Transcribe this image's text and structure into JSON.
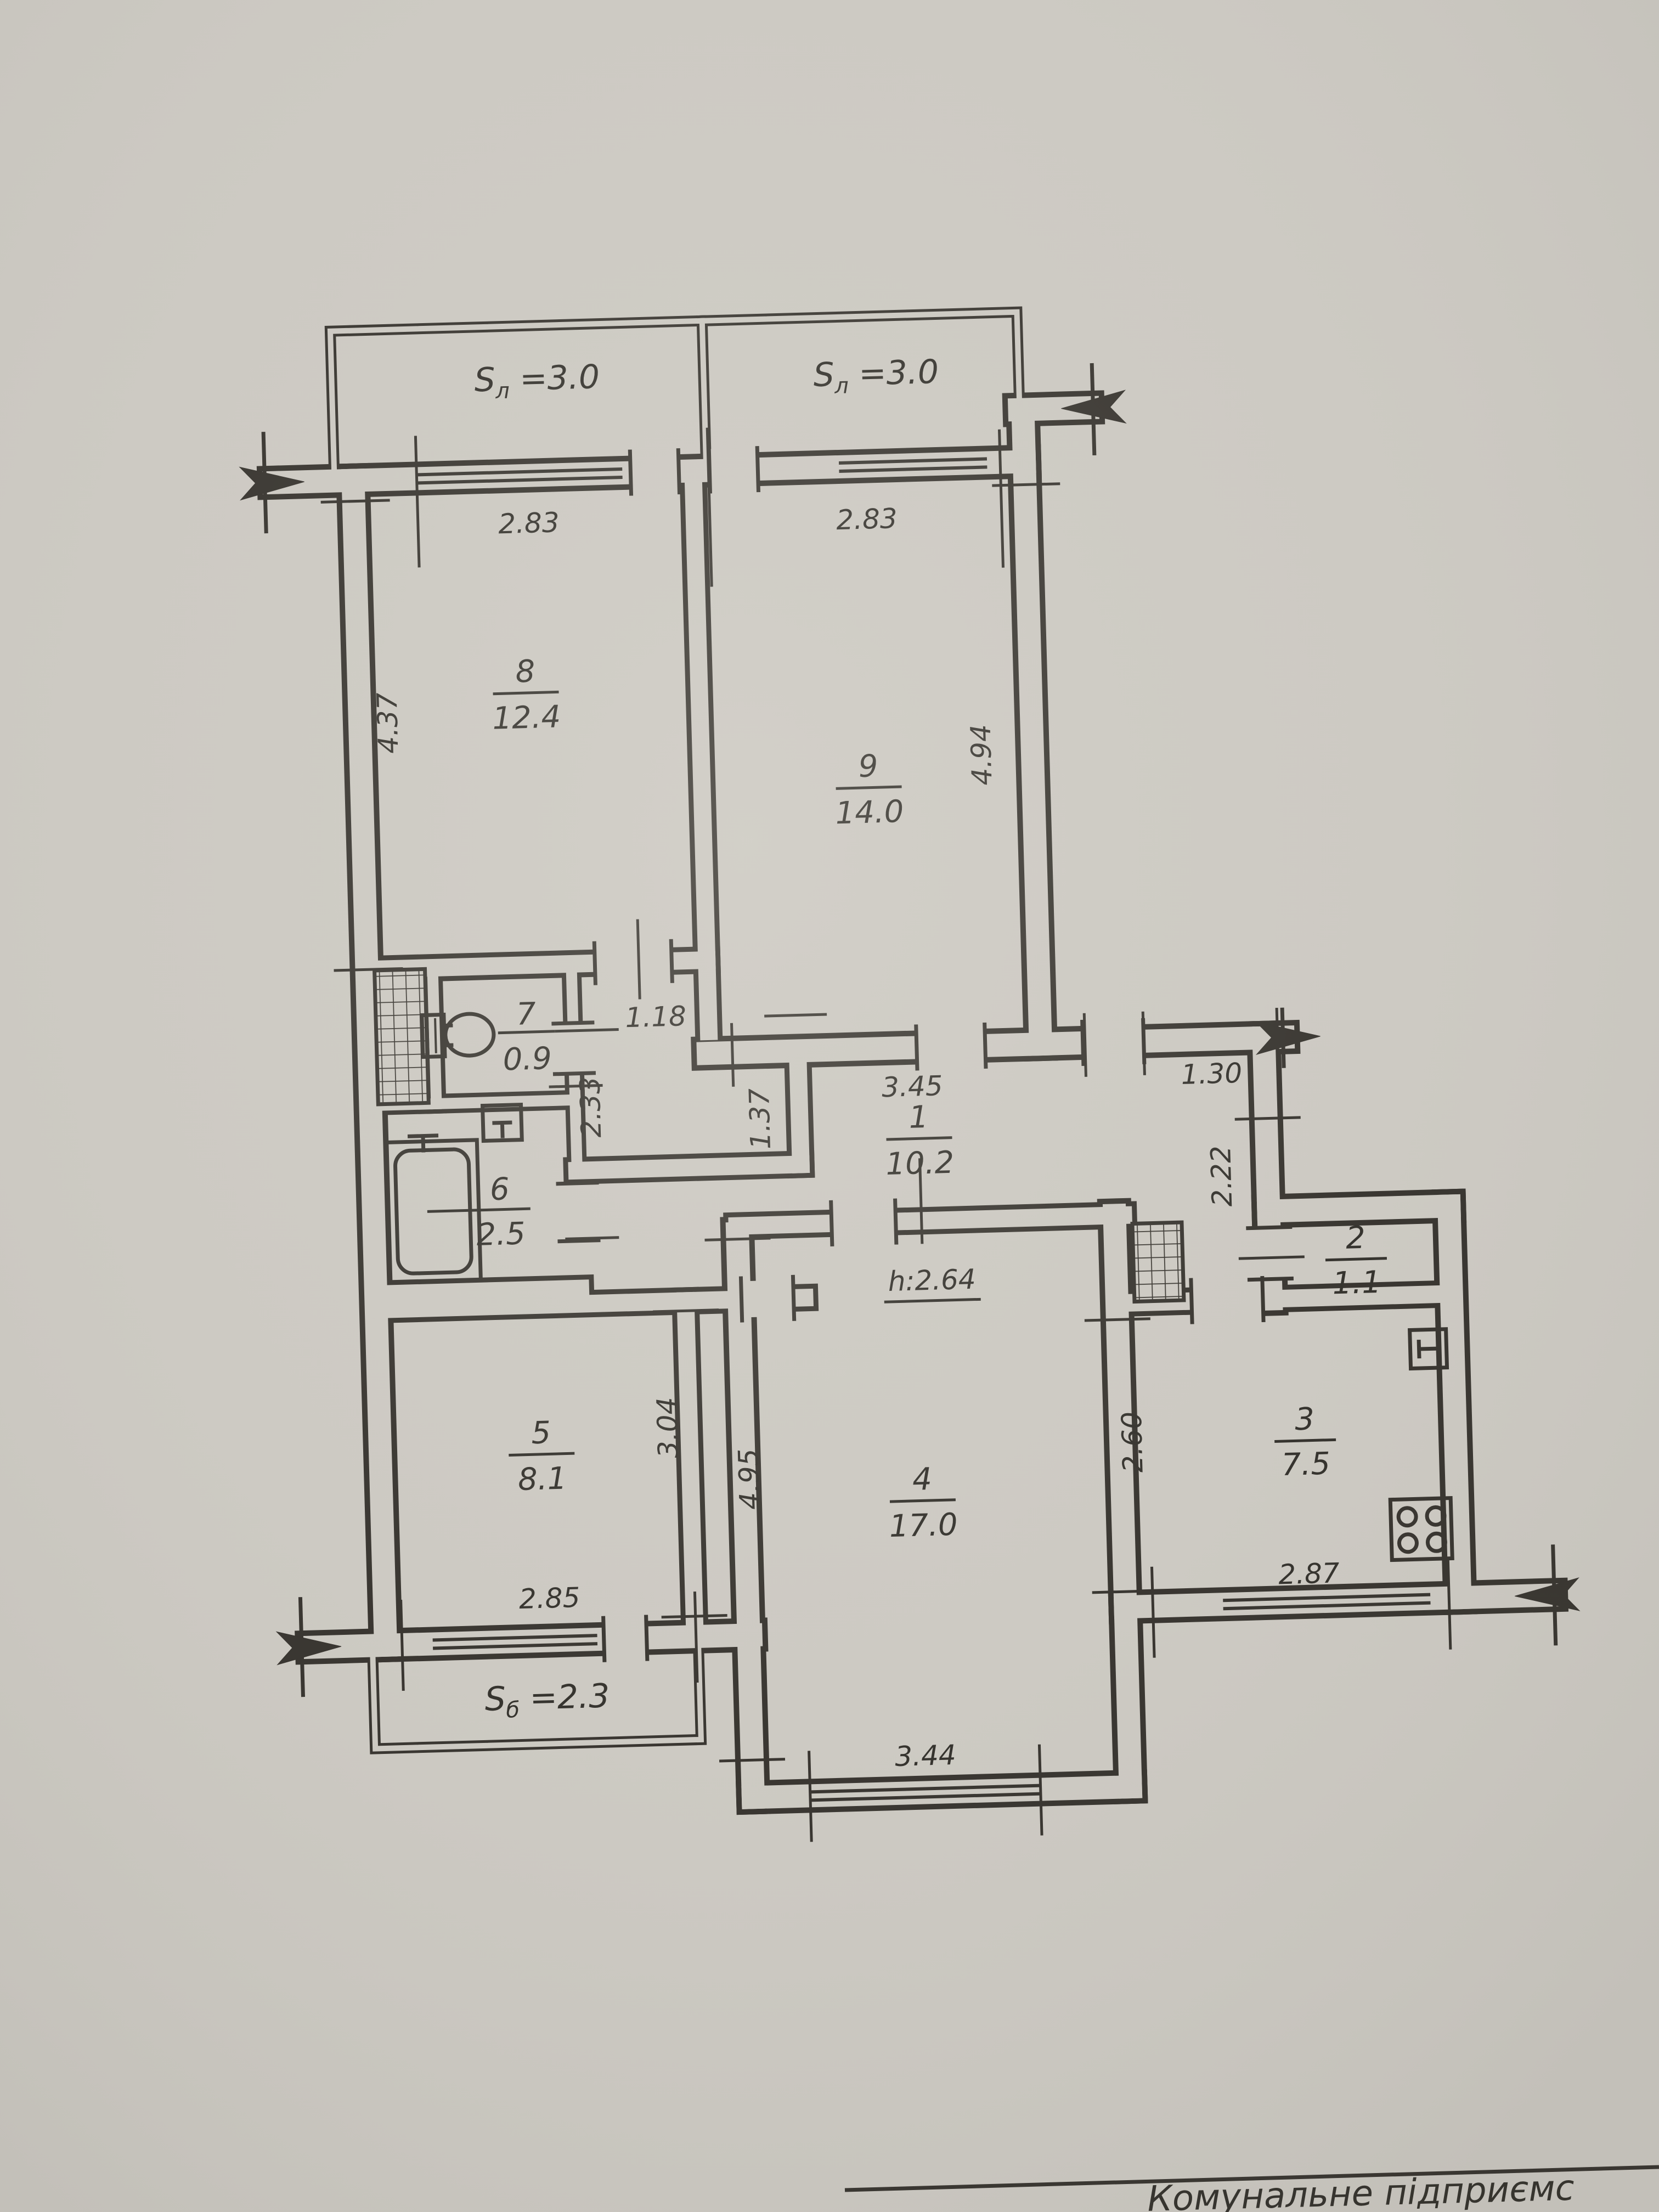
{
  "document": {
    "kind": "apartment floor plan (BTI technical passport drawing)",
    "language": "Ukrainian"
  },
  "rooms": [
    {
      "number": "1",
      "area": "10.2"
    },
    {
      "number": "2",
      "area": "1.1"
    },
    {
      "number": "3",
      "area": "7.5"
    },
    {
      "number": "4",
      "area": "17.0"
    },
    {
      "number": "5",
      "area": "8.1"
    },
    {
      "number": "6",
      "area": "2.5"
    },
    {
      "number": "7",
      "area": "0.9"
    },
    {
      "number": "8",
      "area": "12.4"
    },
    {
      "number": "9",
      "area": "14.0"
    }
  ],
  "balconies": [
    {
      "prefix": "S",
      "sub": "л",
      "value": " =3.0"
    },
    {
      "prefix": "S",
      "sub": "л",
      "value": " =3.0"
    },
    {
      "prefix": "S",
      "sub": "б",
      "value": " =2.3"
    }
  ],
  "dimensions": {
    "balcony8_w": "2.83",
    "balcony9_w": "2.83",
    "room8_h": "4.37",
    "room9_h": "4.94",
    "lobby_w": "1.18",
    "bath_h": "2.33",
    "hall_w": "3.45",
    "hall_left_h": "1.37",
    "corridor_w": "1.30",
    "corridor_h": "2.22",
    "ceiling_height": "h:2.64",
    "room5_w": "2.85",
    "room5_h": "3.04",
    "room4_h": "4.95",
    "room4_w": "3.44",
    "kitchen_h": "2.60",
    "kitchen_w": "2.87"
  },
  "title_block": {
    "text": "Комунальне підприємс"
  },
  "colors": {
    "paper": "#ccc9c2",
    "ink": "#2a2722"
  }
}
